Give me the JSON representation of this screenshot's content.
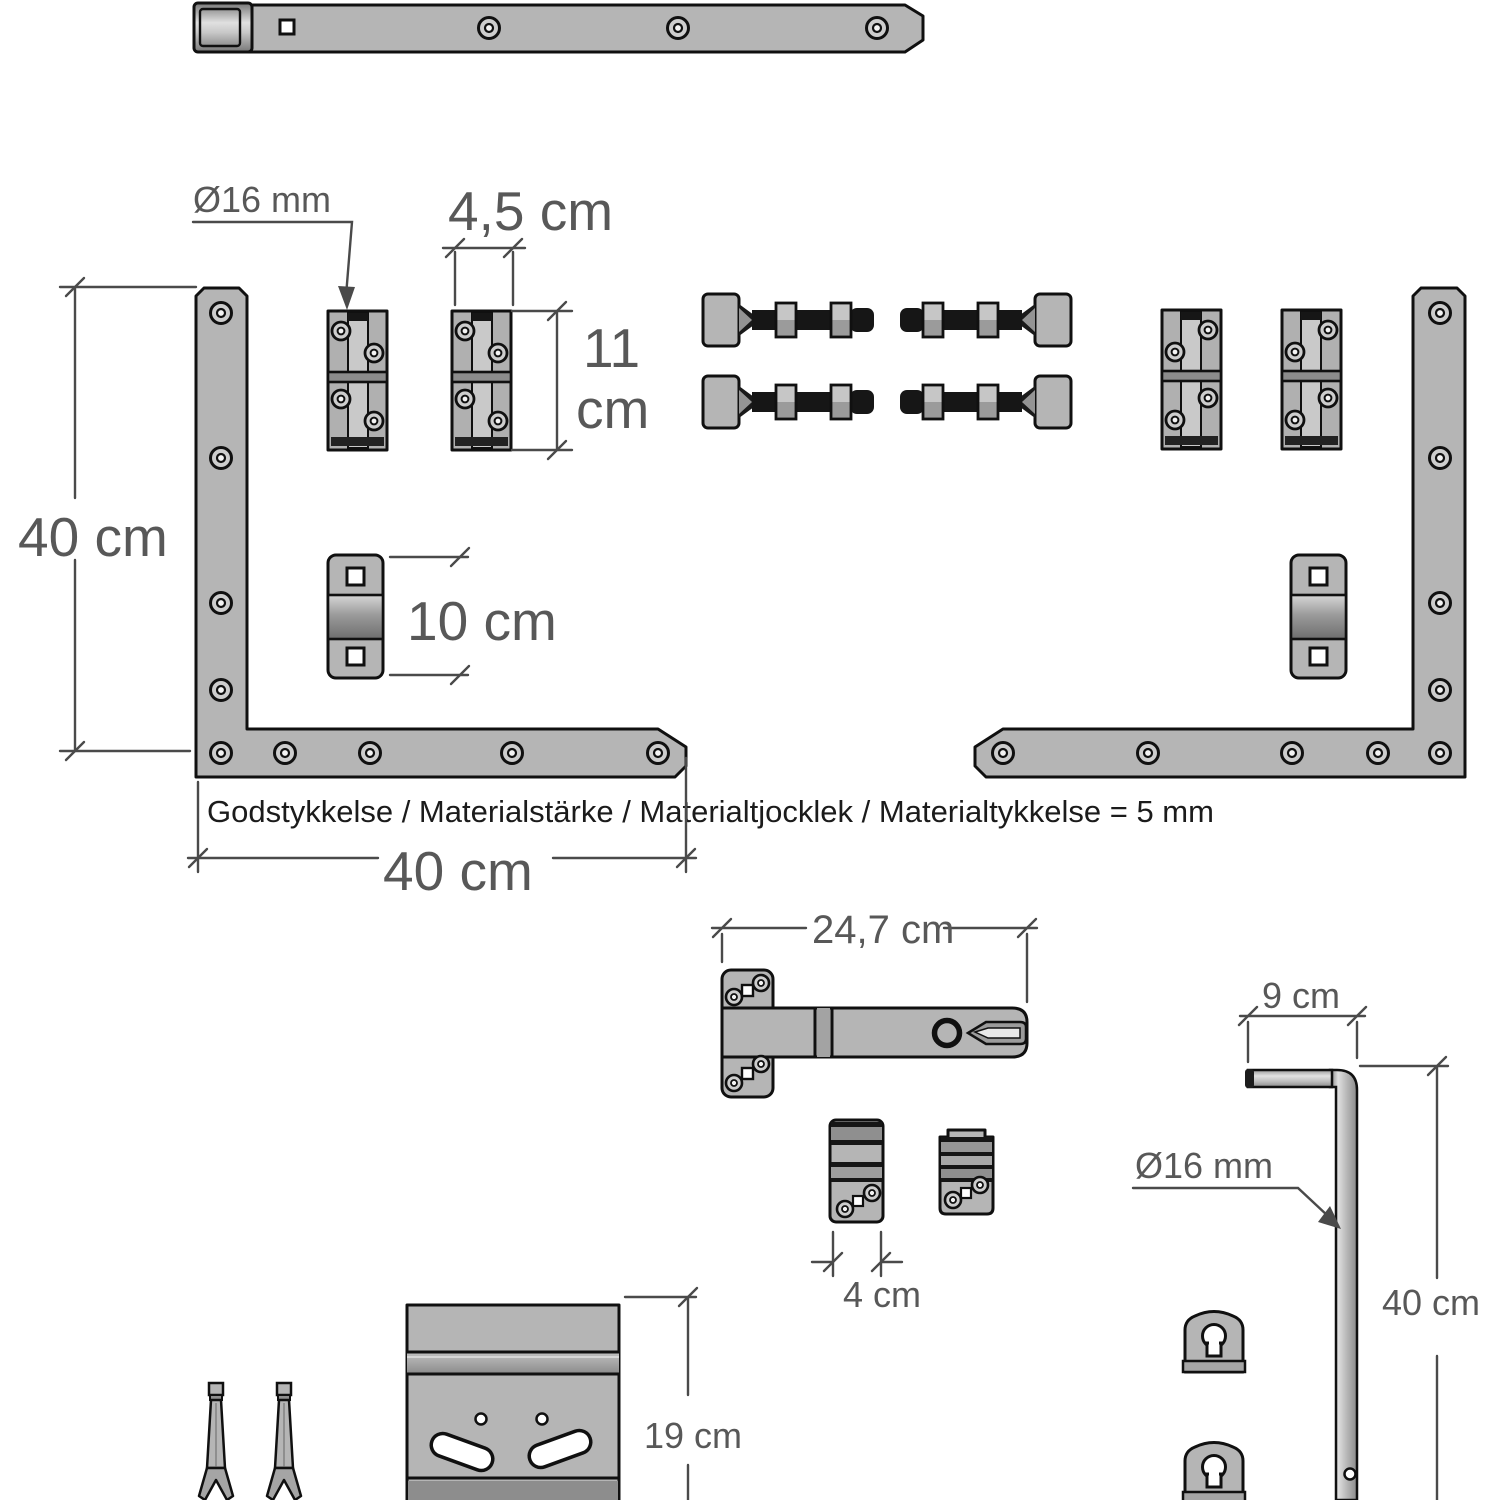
{
  "drawing": {
    "title_hint": "gate hardware technical drawing",
    "colors": {
      "part_fill": "#b5b5b5",
      "outline": "#101010",
      "dimension": "#4a4a4a"
    },
    "labels": {
      "pin_diameter": "Ø16 mm",
      "hinge_width": "4,5 cm",
      "hinge_height_value": "11",
      "hinge_height_unit": "cm",
      "bracket_height": "40 cm",
      "saddle_length": "10 cm",
      "bracket_width": "40 cm",
      "material_note": "Godstykkelse / Materialstärke / Materialtjocklek / Materialtykkelse = 5 mm",
      "latch_length": "24,7 cm",
      "keeper_width": "4 cm",
      "dropbolt_handle_width": "9 cm",
      "dropbolt_diameter": "Ø16 mm",
      "dropbolt_length": "40 cm",
      "plate_height": "19 cm"
    }
  }
}
